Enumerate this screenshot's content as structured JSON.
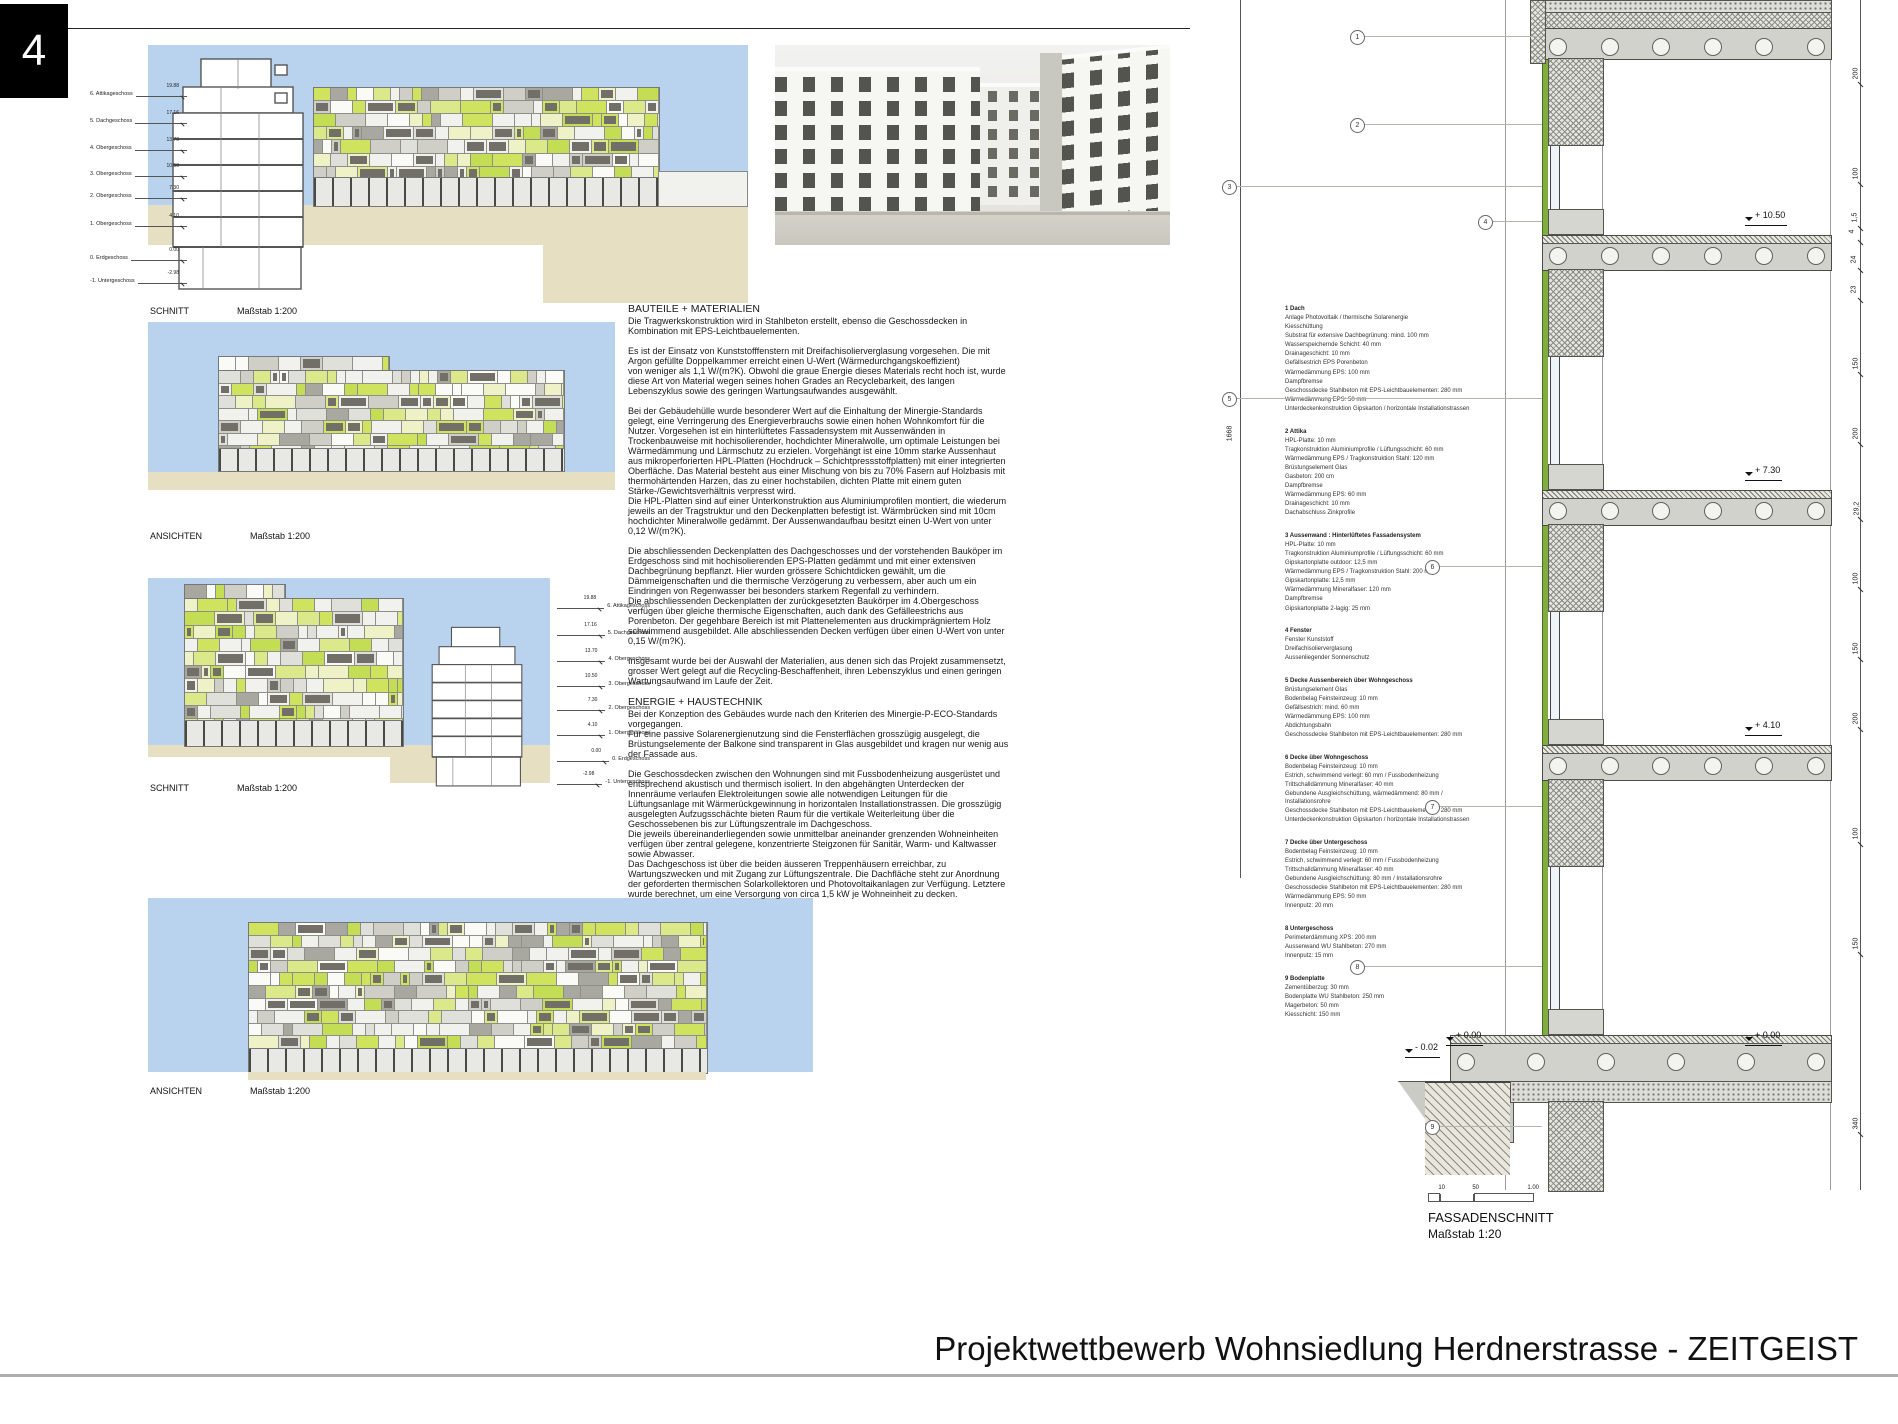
{
  "page": {
    "number": "4",
    "footer_title": "Projektwettbewerb Wohnsiedlung Herdnerstrasse - ZEITGEIST"
  },
  "colors": {
    "sky": "#b9d2ee",
    "ground": "#e7dfc1",
    "accent_green": "#cfe35f",
    "hpl_green": "#7fae3f",
    "slab_gray": "#d2d2cc"
  },
  "drawings": {
    "schnitt1": {
      "label": "SCHNITT",
      "scale": "Maßstab 1:200"
    },
    "ansichten1": {
      "label": "ANSICHTEN",
      "scale": "Maßstab 1:200"
    },
    "schnitt2": {
      "label": "SCHNITT",
      "scale": "Maßstab 1:200"
    },
    "ansichten2": {
      "label": "ANSICHTEN",
      "scale": "Maßstab 1:200"
    },
    "floor_levels": [
      {
        "name": "6. Attikageschoss",
        "elev": "19.88"
      },
      {
        "name": "5. Dachgeschoss",
        "elev": "17.16"
      },
      {
        "name": "4. Obergeschoss",
        "elev": "13.70"
      },
      {
        "name": "3. Obergeschoss",
        "elev": "10.50"
      },
      {
        "name": "2. Obergeschoss",
        "elev": "7.30"
      },
      {
        "name": "1. Obergeschoss",
        "elev": "4.10"
      },
      {
        "name": "0. Erdgeschoss",
        "elev": "0.00"
      },
      {
        "name": "-1. Untergeschoss",
        "elev": "-2.98"
      }
    ]
  },
  "text": {
    "materials_heading": "BAUTEILE + MATERIALIEN",
    "materials_paragraphs": [
      "Die Tragwerkskonstruktion wird in Stahlbeton erstellt, ebenso die Geschossdecken in\nKombination mit EPS-Leichtbauelementen.",
      "Es ist der Einsatz von Kunststofffenstern mit Dreifachisolierverglasung vorgesehen. Die mit\nArgon gefüllte Doppelkammer erreicht einen U-Wert (Wärmedurchgangskoeffizient)\nvon weniger als 1,1 W/(m?K). Obwohl die graue Energie dieses Materials recht hoch ist, wurde\ndiese Art von Material wegen seines hohen Grades an Recyclebarkeit, des langen\nLebenszyklus sowie des geringen Wartungsaufwandes ausgewählt.",
      "Bei der Gebäudehülle wurde besonderer Wert auf die Einhaltung der Minergie-Standards\ngelegt, eine Verringerung des Energieverbrauchs sowie einen hohen Wohnkomfort für die\nNutzer. Vorgesehen ist ein hinterlüftetes Fassadensystem mit Aussenwänden in\nTrockenbauweise mit hochisolierender, hochdichter Mineralwolle, um optimale Leistungen bei\nWärmedämmung und Lärmschutz zu erzielen. Vorgehängt ist eine 10mm starke Aussenhaut\naus mikroperforierten HPL-Platten (Hochdruck – Schichtpressstoffplatten) mit einer integrierten\nOberfläche. Das Material besteht aus einer Mischung von bis zu 70% Fasern auf Holzbasis mit\nthermohärtenden Harzen, das zu einer hochstabilen, dichten Platte mit einem guten\nStärke-/Gewichtsverhältnis verpresst wird.\nDie HPL-Platten sind auf einer Unterkonstruktion aus Aluminiumprofilen montiert, die wiederum\njeweils an der Tragstruktur und den Deckenplatten befestigt ist. Wärmbrücken sind mit 10cm\nhochdichter Mineralwolle gedämmt. Der Aussenwandaufbau besitzt einen U-Wert von unter\n0,12 W/(m?K).",
      "Die abschliessenden Deckenplatten des Dachgeschosses und der vorstehenden Bauköper im\nErdgeschoss sind mit hochisolierenden EPS-Platten gedämmt und mit einer extensiven\nDachbegrünung bepflanzt. Hier wurden grössere Schichtdicken gewählt, um die\nDämmeigenschaften und die thermische Verzögerung zu verbessern, aber auch um ein\nEindringen von Regenwasser bei besonders starkem Regenfall zu verhindern.\nDie abschliessenden Deckenplatten der zurückgesetzten Baukörper im 4.Obergeschoss\nverfügen über gleiche thermische Eigenschaften, auch dank des Gefälleestrichs aus\nPorenbeton. Der gegehbare Bereich ist mit Plattenelementen aus druckimprägniertem Holz\nschwimmend ausgebildet. Alle abschliessenden Decken verfügen über einen U-Wert von unter\n0,15 W/(m?K).",
      "Insgesamt wurde bei der Auswahl der Materialien, aus denen sich das Projekt zusammensetzt,\ngrosser Wert gelegt auf die Recycling-Beschaffenheit, ihren Lebenszyklus und einen geringen\nWartungsaufwand im Laufe der Zeit."
    ],
    "energy_heading": "ENERGIE + HAUSTECHNIK",
    "energy_paragraphs": [
      "Bei der Konzeption des Gebäudes wurde nach den Kriterien des Minergie-P-ECO-Standards\nvorgegangen.\nFür eine passive Solarenergienutzung sind die Fensterflächen grosszügig ausgelegt, die\nBrüstungselemente der Balkone sind transparent in Glas ausgebildet und kragen nur wenig aus\nder Fassade aus.",
      "Die Geschossdecken zwischen den Wohnungen sind mit Fussbodenheizung ausgerüstet und\nentsprechend akustisch und thermisch isoliert. In den abgehängten Unterdecken der\nInnenräume verlaufen Elektroleitungen sowie alle notwendigen Leitungen für die\nLüftungsanlage mit Wärmerückgewinnung in horizontalen Installationstrassen. Die grosszügig\nausgelegten Aufzugsschächte bieten Raum für die vertikale Weiterleitung über die\nGeschossebenen bis zur Lüftungszentrale im Dachgeschoss.\nDie jeweils übereinanderliegenden sowie unmittelbar aneinander grenzenden Wohneinheiten\nverfügen über zentral gelegene, konzentrierte Steigzonen für Sanitär, Warm- und Kaltwasser\nsowie Abwasser.\nDas Dachgeschoss ist über die beiden äusseren Treppenhäusern erreichbar, zu\nWartungszwecken und mit Zugang zur Lüftungszentrale. Die Dachfläche steht zur Anordnung\nder geforderten thermischen Solarkollektoren und Photovoltaikanlagen zur Verfügung. Letztere\nwurde berechnet, um eine Versorgung von circa 1,5 kW je Wohneinheit zu decken."
    ]
  },
  "layers": {
    "sections": [
      {
        "num": "1",
        "title": "Dach",
        "items": [
          "Anlage Photovoltaik / thermische Solarenergie",
          "Kiesschüttung",
          "Substrat für extensive Dachbegrünung: mind. 100 mm",
          "Wasserspeichernde Schicht: 40 mm",
          "Drainageschicht: 10 mm",
          "Gefällsestrich EPS Porenbeton",
          "Wärmedämmung EPS: 100 mm",
          "Dampfbremse",
          "Geschossdecke Stahlbeton mit EPS-Leichtbauelementen: 280 mm",
          "Wärmedämmung EPS: 50 mm",
          "Unterdeckenkonstruktion Gipskarton / horizontale Installationstrassen"
        ]
      },
      {
        "num": "2",
        "title": "Attika",
        "items": [
          "HPL-Platte: 10 mm",
          "Tragkonstruktion Aluminiumprofile / Lüftungsschicht: 60 mm",
          "Wärmedämmung EPS / Tragkonstruktion Stahl: 120 mm",
          "Brüstungselement Glas",
          "Gasbeton: 200 cm",
          "Dampfbremse",
          "Wärmedämmung EPS: 60 mm",
          "Drainageschicht: 10 mm",
          "Dachabschluss Zinkprofile"
        ]
      },
      {
        "num": "3",
        "title": "Aussenwand : Hinterlüftetes Fassadensystem",
        "items": [
          "HPL-Platte: 10 mm",
          "Tragkonstruktion Aluminiumprofile / Lüftungsschicht: 60 mm",
          "Gipskartonplatte outdoor: 12,5 mm",
          "Wärmedämmung EPS / Tragkonstruktion Stahl: 200 mm",
          "Gipskartonplatte: 12,5 mm",
          "Wärmedämmung Mineralfaser: 120 mm",
          "Dampfbremse",
          "Gipskartonplatte 2-lagig: 25 mm"
        ]
      },
      {
        "num": "4",
        "title": "Fenster",
        "items": [
          "Fenster Kunststoff",
          "Dreifachisolierverglasung",
          "Aussenliegender Sonnenschutz"
        ]
      },
      {
        "num": "5",
        "title": "Decke Aussenbereich über Wohngeschoss",
        "items": [
          "Brüstungselement Glas",
          "Bodenbelag Feinsteinzeug: 10 mm",
          "Gefällsestrich: mind. 60 mm",
          "Wärmedämmung EPS: 100 mm",
          "Abdichtungsbahn",
          "Geschossdecke Stahlbeton mit EPS-Leichtbauelementen: 280 mm"
        ]
      },
      {
        "num": "6",
        "title": "Decke über Wohngeschoss",
        "items": [
          "Bodenbelag Feinsteinzeug: 10 mm",
          "Estrich, schwimmend verlegt: 60 mm / Fussbodenheizung",
          "Trittschalldämmung Mineralfaser: 40 mm",
          "Gebundene Ausgleichschüttung, wärmedämmend: 80 mm / Installationsrohre",
          "Geschossdecke Stahlbeton mit EPS-Leichtbauelementen: 280 mm",
          "Unterdeckenkonstruktion Gipskarton / horizontale Installationstrassen"
        ]
      },
      {
        "num": "7",
        "title": "Decke über Untergeschoss",
        "items": [
          "Bodenbelag Feinsteinzeug: 10 mm",
          "Estrich, schwimmend verlegt: 60 mm / Fussbodenheizung",
          "Trittschalldämmung Mineralfaser: 40 mm",
          "Gebundene Ausgleichschüttung: 80 mm / Installationsrohre",
          "Geschossdecke Stahlbeton mit EPS-Leichtbauelementen: 280 mm",
          "Wärmedämmung EPS: 50 mm",
          "Innenputz: 20 mm"
        ]
      },
      {
        "num": "8",
        "title": "Untergeschoss",
        "items": [
          "Perimeterdämmung XPS: 200 mm",
          "Aussenwand WU Stahlbeton: 270 mm",
          "Innenputz: 15 mm"
        ]
      },
      {
        "num": "9",
        "title": "Bodenplatte",
        "items": [
          "Zementüberzug: 30 mm",
          "Bodenplatte WU Stahlbeton: 250 mm",
          "Magerbeton: 50 mm",
          "Kiesschicht: 150 mm"
        ]
      }
    ]
  },
  "fassade": {
    "title": "FASSADENSCHNITT",
    "scale": "Maßstab 1:20",
    "scalebar": [
      "10",
      "50",
      "1.00"
    ],
    "total_dim": "1668",
    "elevations": [
      "+ 10.50",
      "+ 7.30",
      "+ 4.10",
      "- 0.02",
      "+ 0.00",
      "+ 0.00"
    ],
    "dims_right": [
      "200",
      "100",
      "1,5",
      "4",
      "24",
      "23",
      "150",
      "200",
      "29,2",
      "100",
      "150",
      "200",
      "100",
      "150",
      "340"
    ],
    "refs": [
      "1",
      "2",
      "3",
      "4",
      "5",
      "6",
      "7",
      "8",
      "9"
    ]
  }
}
